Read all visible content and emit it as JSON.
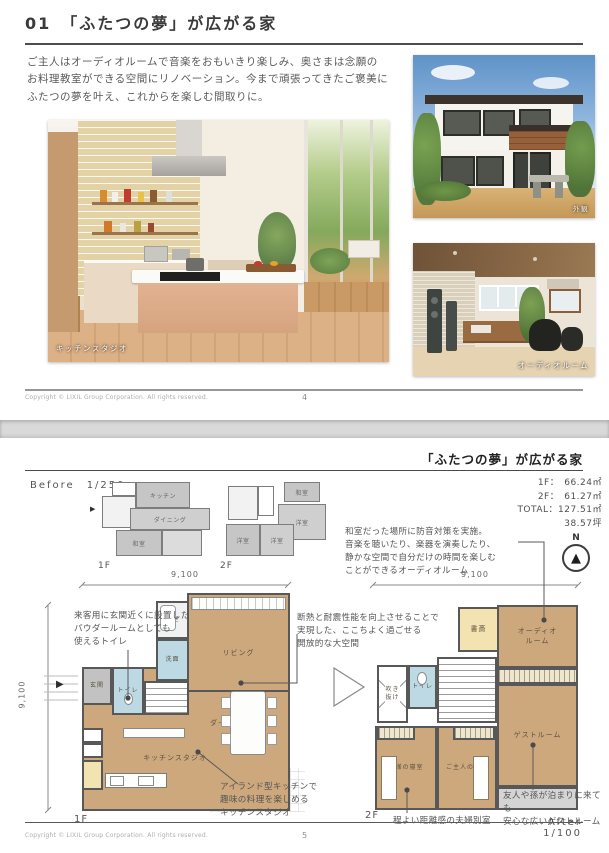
{
  "page1": {
    "title": "01　「ふたつの夢」が広がる家",
    "intro": "ご主人はオーディオルームで音楽をおもいきり楽しみ、奥さまは念願の\nお料理教室ができる空間にリノベーション。今まで頑張ってきたご褒美に\nふたつの夢を叶え、これからを楽しむ間取りに。",
    "caption_kitchen": "キッチンスタジオ",
    "caption_exterior": "外観",
    "caption_audio": "オーディオルーム",
    "copyright": "Copyright © LIXIL Group Corporation. All rights reserved.",
    "page_number": "4"
  },
  "page2": {
    "title": "「ふたつの夢」が広がる家",
    "before_label": "Before　1/250",
    "after_label": "After　1/100",
    "floor_1f": "1F",
    "floor_2f": "2F",
    "north_label": "N",
    "dim": "9,100",
    "area": {
      "f1_label": "1F：",
      "f1_value": "66.24㎡",
      "f2_label": "2F：",
      "f2_value": "61.27㎡",
      "total_label": "TOTAL：",
      "total_value": "127.51㎡",
      "tsubo": "38.57坪"
    },
    "note_audio": "和室だった場所に防音対策を実施。\n音楽を聴いたり、楽器を演奏したり、\n静かな空間で自分だけの時間を楽しむ\nことができるオーディオルーム",
    "note_toilet": "来客用に玄関近くに設置した\nパウダールームとしても\n使えるトイレ",
    "note_kitchen": "アイランド型キッチンで\n趣味の料理を楽しめる\nキッチンスタジオ",
    "note_insulation": "断熱と耐震性能を向上させることで\n実現した、ここちよく過ごせる\n開放的な大空間",
    "note_guest": "友人や孫が泊まりに来ても\n安心な広いゲストルーム",
    "note_couple": "程よい距離感の夫婦別室",
    "before_1f_rooms": {
      "kitchen": "キッチン",
      "dining": "ダイニング",
      "washitsu": "和室"
    },
    "before_2f_rooms": {
      "washitsu": "和室",
      "yoshitsu1": "洋室",
      "yoshitsu2": "洋室",
      "yoshitsu3": "洋室"
    },
    "after_1f_rooms": {
      "bath": "浴室",
      "wash": "洗面",
      "living": "リビング",
      "genkan": "玄関",
      "toilet": "トイレ",
      "dining": "ダイニング",
      "kitchen": "キッチンスタジオ"
    },
    "after_2f_rooms": {
      "study": "書斎",
      "audio": "オーディオ\nルーム",
      "void": "吹き\n抜け",
      "toilet": "トイレ",
      "guest": "ゲストルーム",
      "wife": "奥様の寝室",
      "husband": "ご主人の寝室"
    },
    "copyright": "Copyright © LIXIL Group Corporation. All rights reserved.",
    "page_number": "5"
  },
  "colors": {
    "plan_beige": "#cda87d",
    "plan_blue": "#bcd9e4",
    "plan_yellow": "#f2e3b0",
    "plan_gray": "#c2c2c2",
    "wall": "#585858",
    "separator": "#d9d9d9"
  }
}
